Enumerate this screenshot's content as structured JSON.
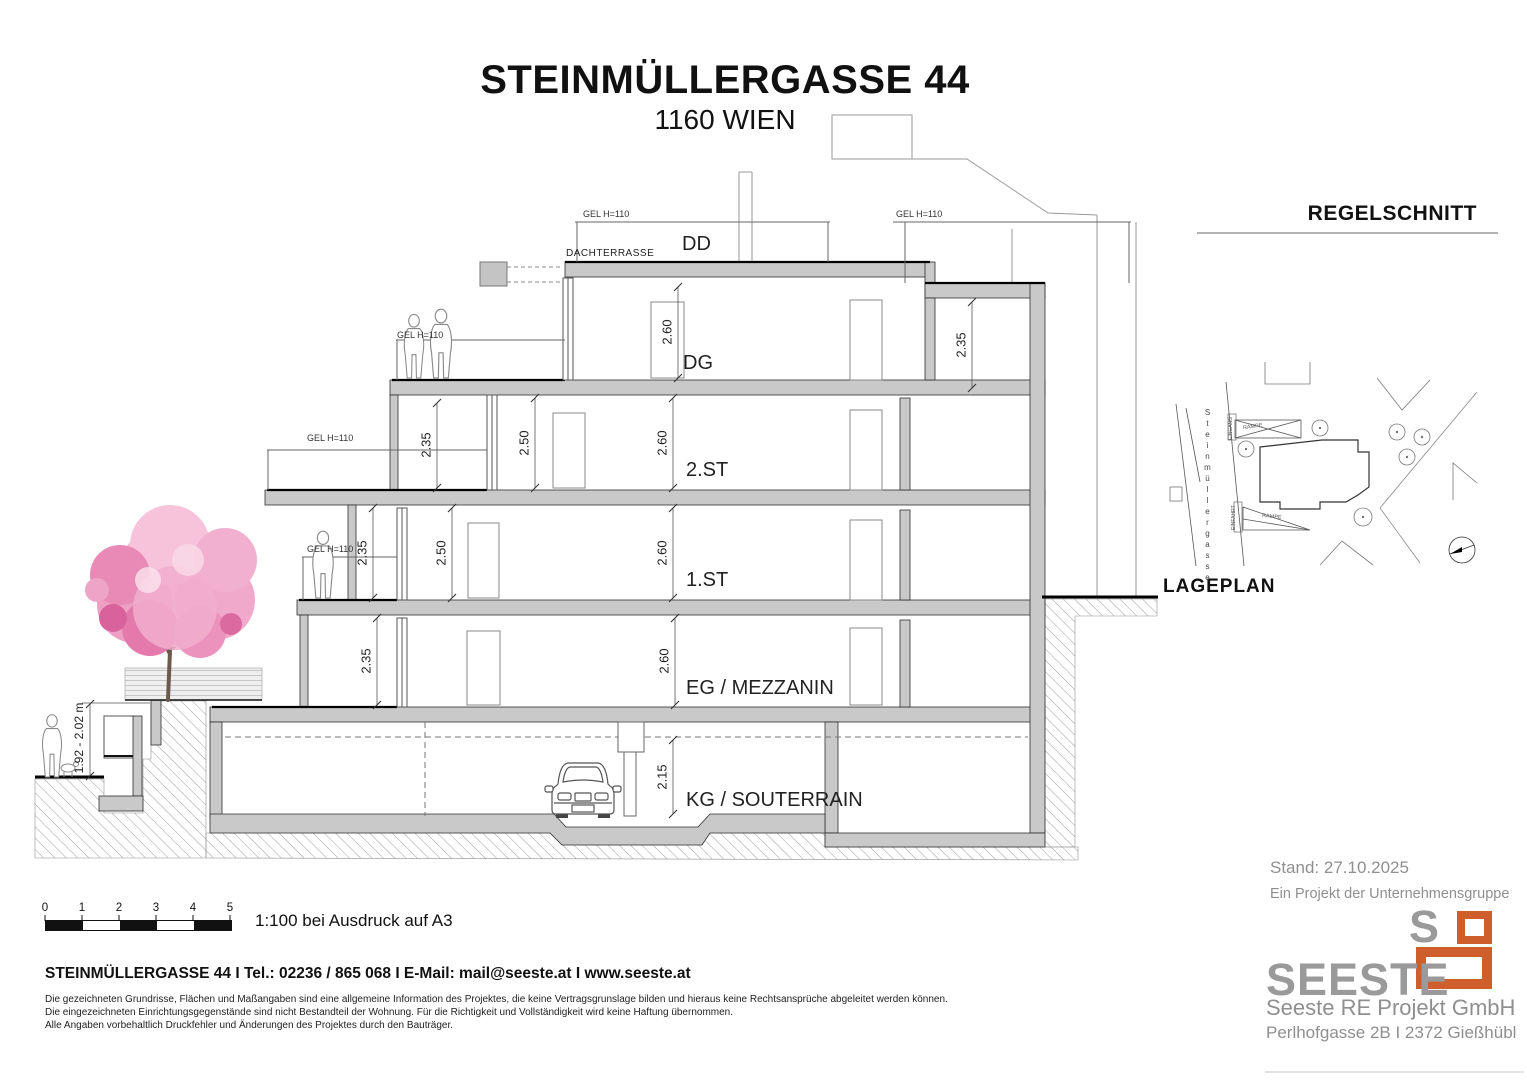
{
  "page": {
    "title": "STEINMÜLLERGASSE 44",
    "subtitle": "1160 WIEN"
  },
  "section": {
    "heading": "REGELSCHNITT",
    "floors": {
      "dd": "DD",
      "dachterrasse": "DACHTERRASSE",
      "dg": "DG",
      "st2": "2.ST",
      "st1": "1.ST",
      "eg": "EG / MEZZANIN",
      "kg": "KG / SOUTERRAIN"
    },
    "railing_label": "GEL H=110",
    "dims": {
      "dg_main": "2.60",
      "dg_right": "2.35",
      "st2_terrace": "2.35",
      "st2_loggia": "2.50",
      "st2_main": "2.60",
      "st1_balcony": "2.35",
      "st1_loggia": "2.50",
      "st1_main": "2.60",
      "eg_terrace": "2.35",
      "eg_main": "2.60",
      "kg_main": "2.15",
      "street_height": "1.92 - 2.02 m"
    }
  },
  "siteplan": {
    "heading": "LAGEPLAN",
    "street_name": "Steinmüllergasse",
    "ramp_label_top": "RAMPE",
    "ramp_label_bottom": "RAMPE",
    "entrance_label": "EINGANG",
    "driveway_label": "EINFAHRT"
  },
  "scalebar": {
    "ticks": [
      "0",
      "1",
      "2",
      "3",
      "4",
      "5"
    ],
    "note": "1:100 bei Ausdruck auf A3"
  },
  "footer": {
    "contact": "STEINMÜLLERGASSE 44 I Tel.: 02236 / 865 068 I E-Mail: mail@seeste.at I www.seeste.at",
    "disclaimer": [
      "Die gezeichneten Grundrisse, Flächen und Maßangaben sind eine allgemeine Information des Projektes, die keine Vertragsgrunslage bilden und hieraus keine Rechtsansprüche abgeleitet werden können.",
      "Die eingezeichneten Einrichtungsgegenstände sind nicht Bestandteil der Wohnung. Für die Richtigkeit und Vollständigkeit wird keine Haftung übernommen.",
      "Alle Angaben vorbehaltlich Druckfehler und Änderungen des Projektes durch den Bauträger."
    ]
  },
  "publisher": {
    "status": "Stand: 27.10.2025",
    "group": "Ein Projekt der Unternehmensgruppe",
    "logo_s": "S",
    "logo_text": "SEESTE",
    "company": "Seeste RE Projekt GmbH",
    "address": "Perlhofgasse 2B I 2372 Gießhübl",
    "accent_color": "#CE5F2D",
    "gray_color": "#9A9A9A"
  }
}
